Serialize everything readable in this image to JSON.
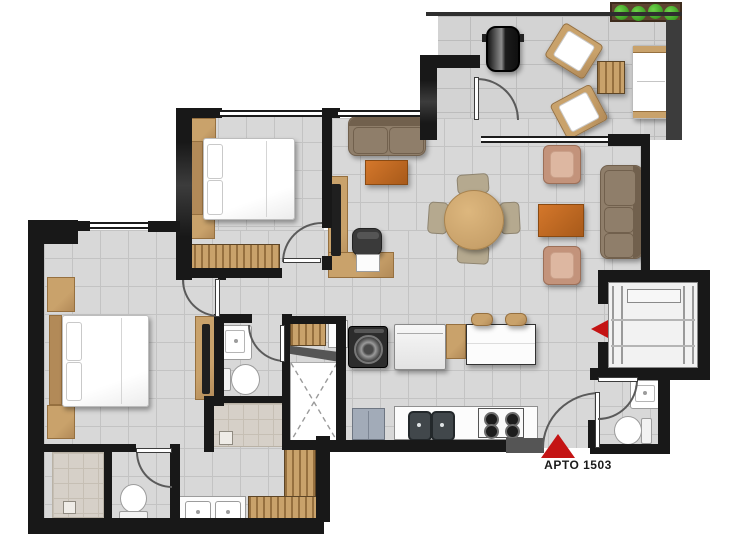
{
  "plan": {
    "unit_label": "APTO 1503",
    "markers": {
      "entry": "red-triangle-up",
      "elevator": "red-triangle-left"
    },
    "rooms": [
      "balcony-terrace",
      "living-dining",
      "study-corner",
      "bedroom",
      "master-bedroom",
      "bathroom",
      "master-bathroom",
      "powder-room",
      "kitchen",
      "laundry",
      "duct-shaft",
      "elevator",
      "entry-hall"
    ]
  },
  "colors": {
    "bg": "#ffffff",
    "wall": "#181818",
    "wall-mid": "#3c3c3c",
    "wall-light": "#555555",
    "floor": "#d8d8d8",
    "floor-grid": "#c3c3c3",
    "balcony-floor": "#d3d3d3",
    "balcony-grid": "#bcbcbc",
    "shower-floor": "#d6d0c8",
    "shower-grid": "#c6bfb4",
    "wood": "#c9a26b",
    "wood-mid": "#b28a58",
    "wood-dark": "#96703f",
    "orange": "#d4772b",
    "orange-dark": "#a85a1a",
    "sofa": "#8f7e6a",
    "sofa-dark": "#71604d",
    "armchair": "#ddb7a1",
    "armchair-dark": "#c3937b",
    "chair": "#b5a98f",
    "white-furn": "#fcfcfc",
    "furn-border": "#9c9c9c",
    "appliance-dark": "#2c2c2c",
    "blue-gray": "#a2abb8",
    "marker": "#c41414",
    "plant": "#41a226",
    "soil": "#5e4430",
    "door": "#5a5a5a",
    "text": "#1b1b1b"
  }
}
